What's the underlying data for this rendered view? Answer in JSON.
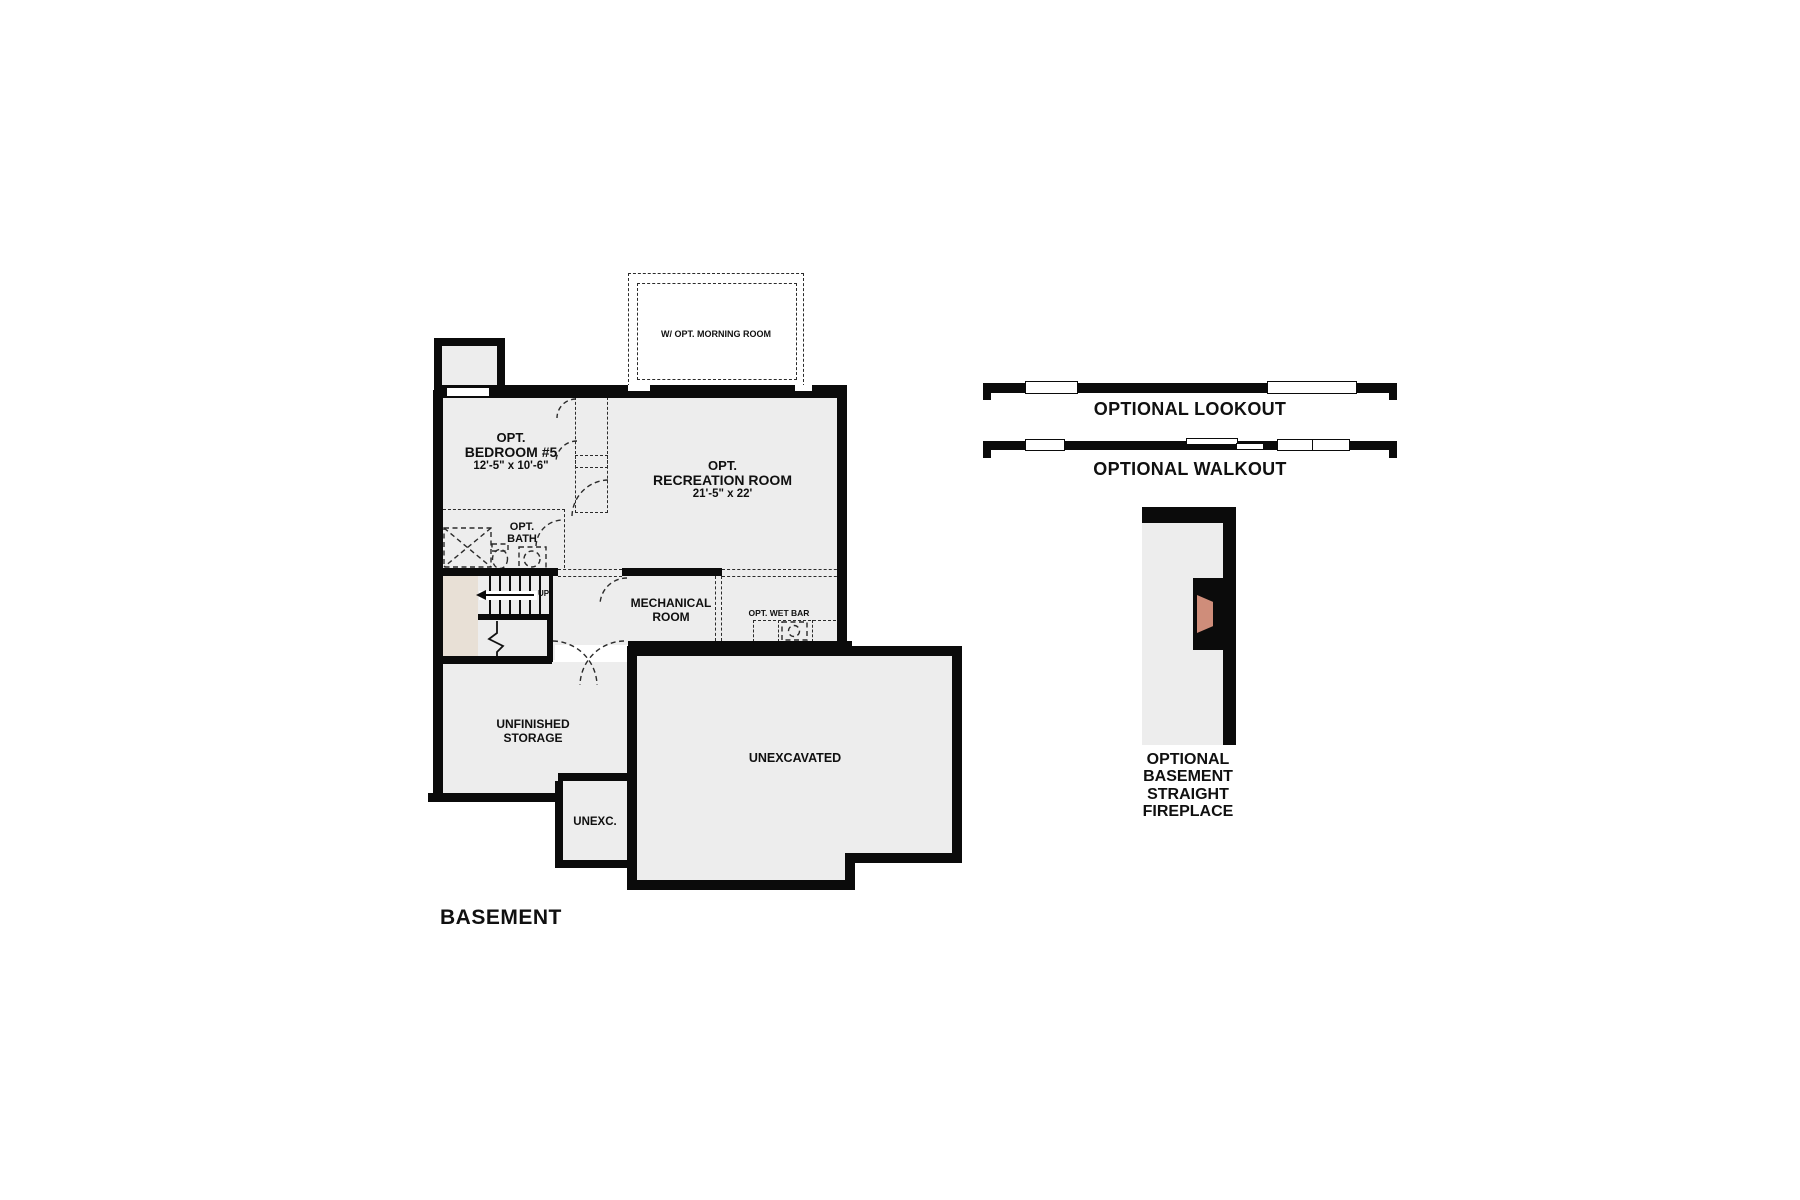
{
  "title": "BASEMENT",
  "floor_plan": {
    "morning_room": {
      "label": "W/ OPT. MORNING ROOM"
    },
    "bedroom": {
      "opt": "OPT.",
      "name": "BEDROOM #5",
      "dims": "12'-5\" x 10'-6\""
    },
    "recreation": {
      "opt": "OPT.",
      "name": "RECREATION ROOM",
      "dims": "21'-5\" x 22'"
    },
    "bath": {
      "opt": "OPT.",
      "name": "BATH"
    },
    "stairs": {
      "direction": "UP"
    },
    "mechanical": {
      "name_line1": "MECHANICAL",
      "name_line2": "ROOM"
    },
    "wet_bar": {
      "label": "OPT. WET BAR"
    },
    "storage": {
      "name_line1": "UNFINISHED",
      "name_line2": "STORAGE"
    },
    "unexc_small": {
      "label": "UNEXC."
    },
    "unexcavated": {
      "label": "UNEXCAVATED"
    }
  },
  "options_panel": {
    "lookout": {
      "label": "OPTIONAL LOOKOUT"
    },
    "walkout": {
      "label": "OPTIONAL WALKOUT"
    },
    "fireplace": {
      "line1": "OPTIONAL",
      "line2": "BASEMENT",
      "line3": "STRAIGHT",
      "line4": "FIREPLACE"
    }
  },
  "colors": {
    "wall": "#0b0b0b",
    "room_fill": "#ededed",
    "under_stair_fill": "#e8e0d6",
    "fireplace_accent": "#cf8d7a",
    "dash": "#2b2b2b"
  }
}
